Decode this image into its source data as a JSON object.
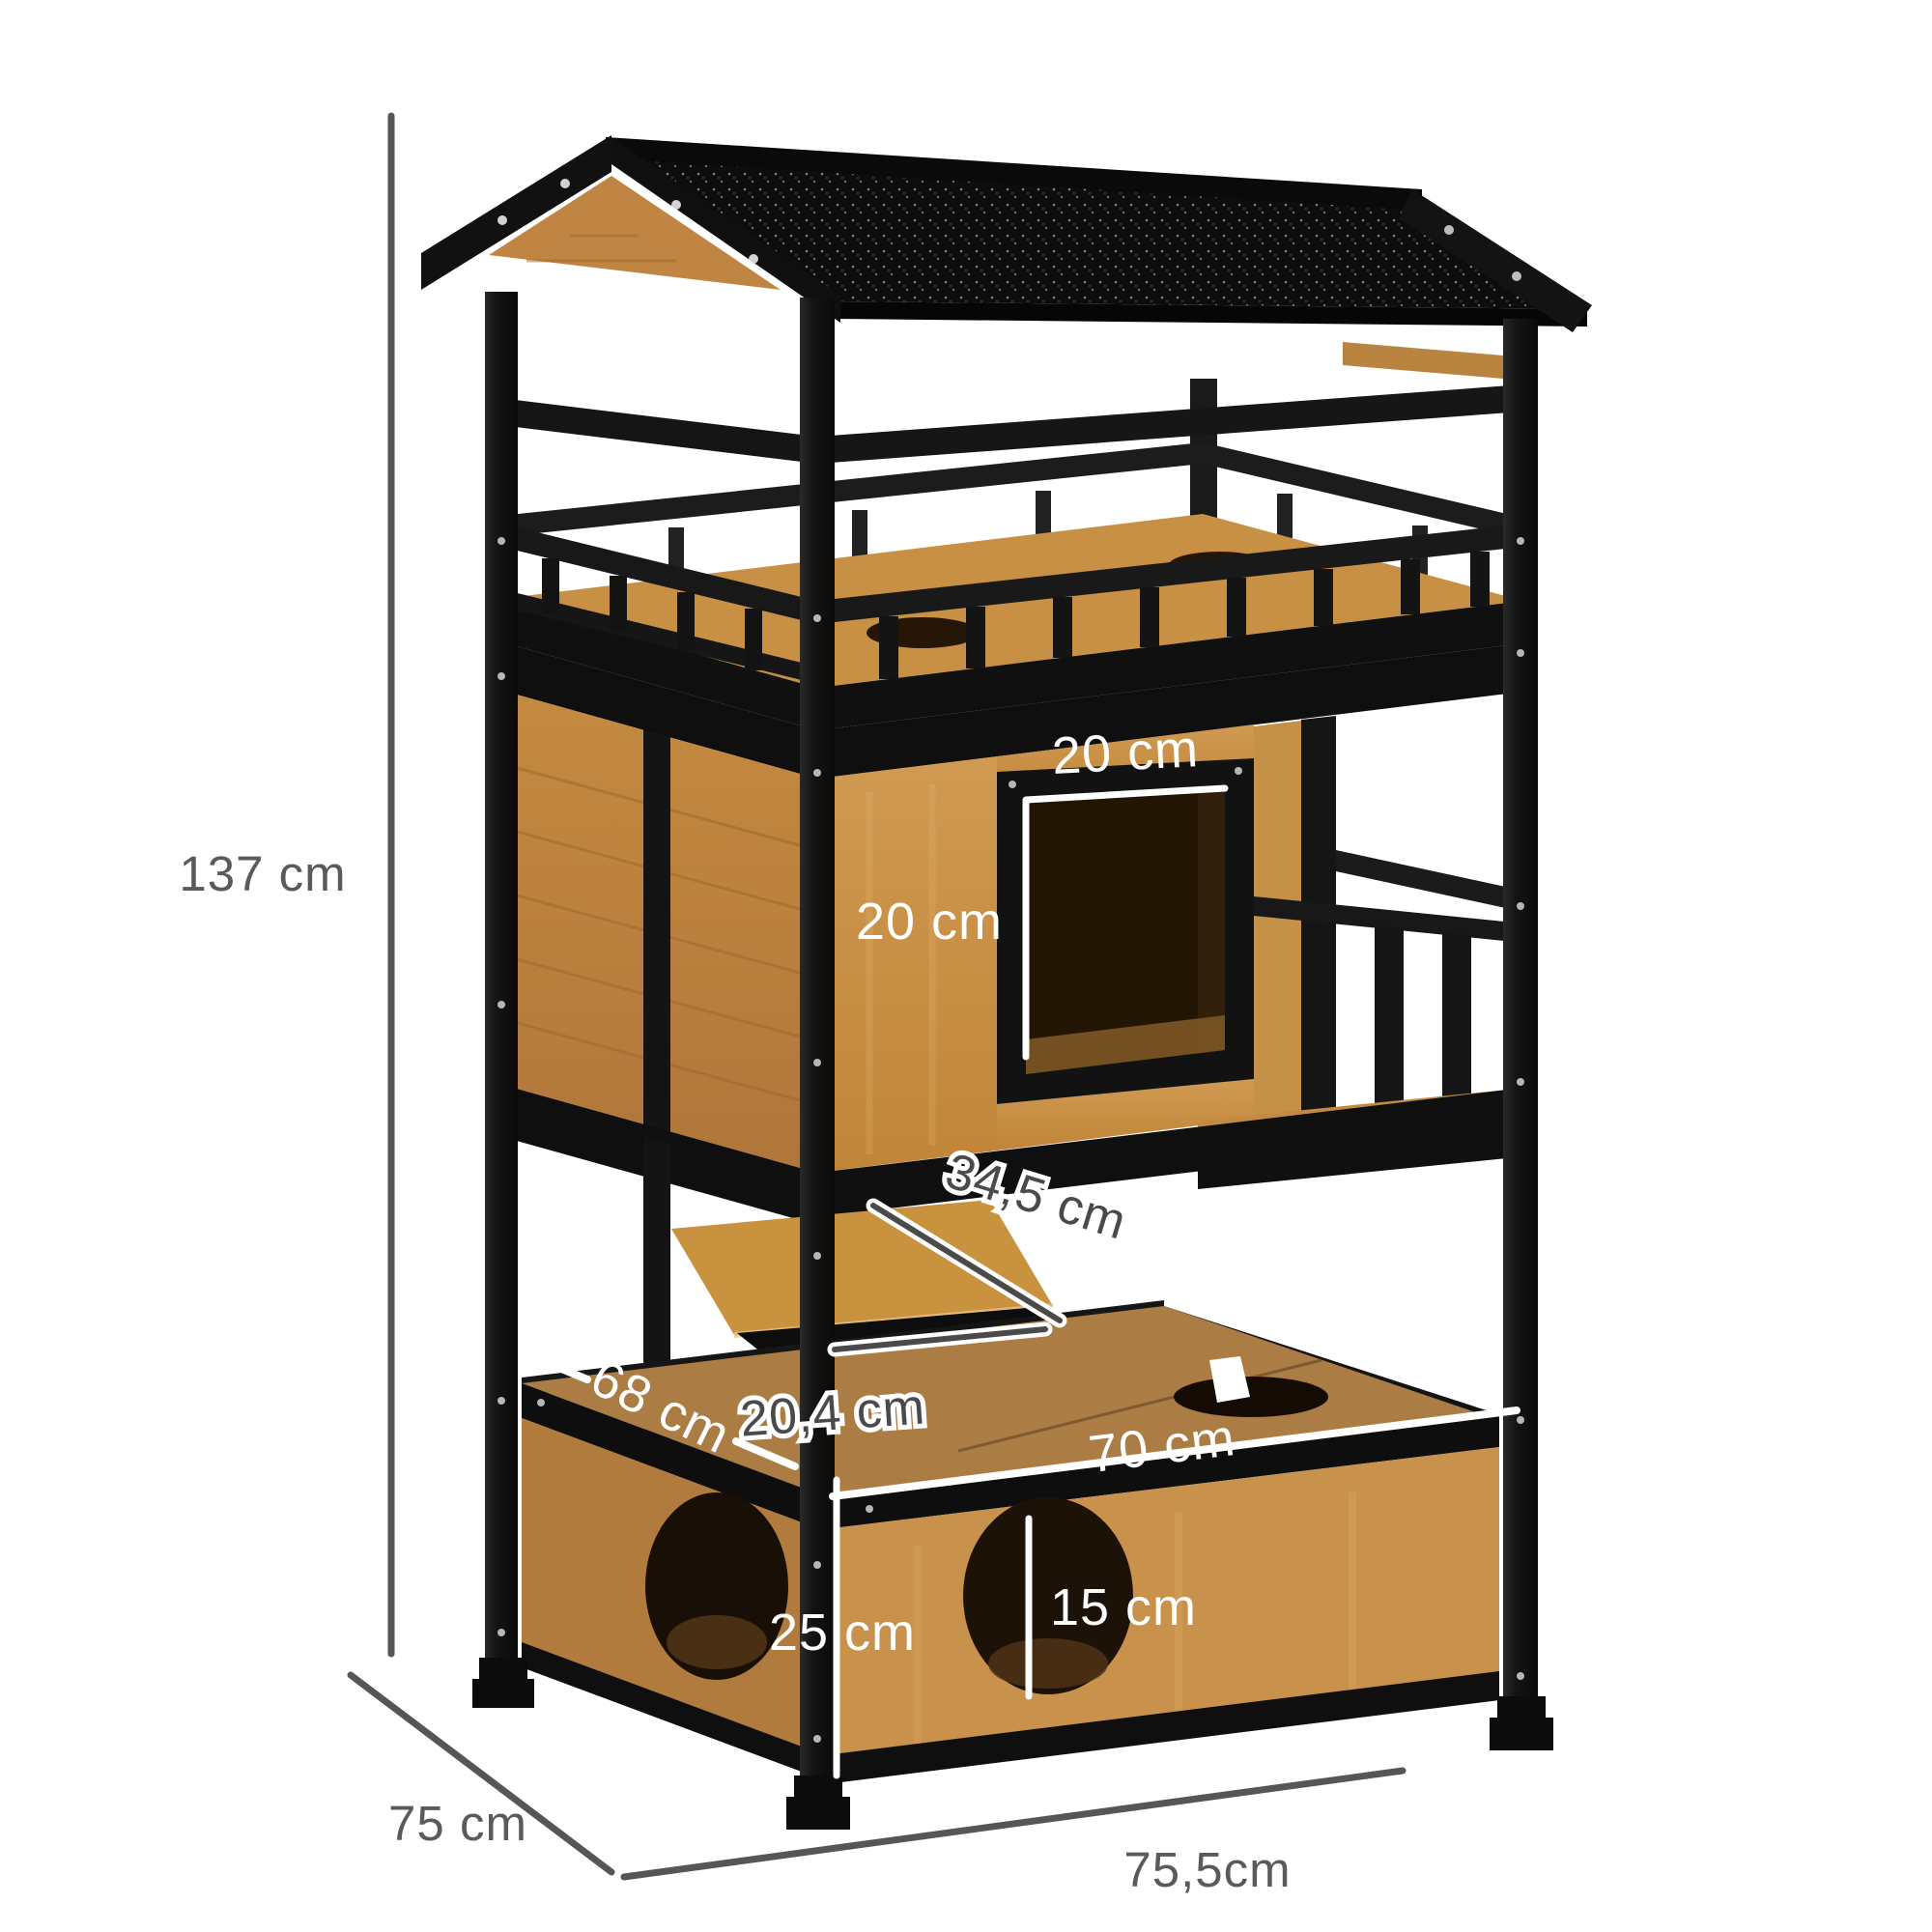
{
  "figure": {
    "alt": "Wooden outdoor cat house with black asphalt roof, balcony, cat door, step platforms and litter-box base, annotated with dimensions"
  },
  "dimensions": {
    "overall_height": "137 cm",
    "base_depth": "75 cm",
    "base_width": "75,5cm",
    "door_width": "20 cm",
    "door_height": "20 cm",
    "step_length": "34,5 cm",
    "step_depth": "20,4 cm",
    "top_depth": "68 cm",
    "top_width": "70 cm",
    "base_height": "25 cm",
    "hole_diameter": "15 cm"
  },
  "colors": {
    "wood": "#c8913f",
    "wood_dark": "#b27b3e",
    "wood_top": "#ab7c44",
    "frame_black": "#141414",
    "roof_black": "#0d0d0d",
    "dim_gray": "#5a5a5a",
    "dim_white": "#ffffff",
    "background": "#ffffff"
  }
}
